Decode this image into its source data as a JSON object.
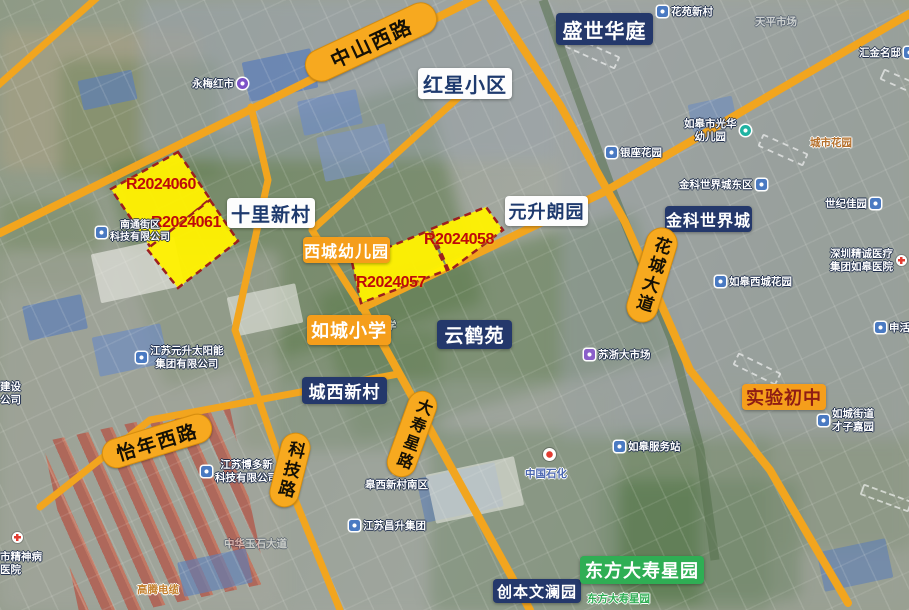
{
  "colors": {
    "road": "#F2A51E",
    "road_label_bg": "#F7A91F",
    "parcel_fill": "#FFF101",
    "parcel_border": "#9C1F1F",
    "parcel_text": "#BE0A0A",
    "navy_label_bg": "#24386B",
    "white_label_text": "#1E3A6E",
    "orange_label_bg": "#F59E1B",
    "green_label_bg": "#2FAE54",
    "experimental_school_text": "#8F1D14"
  },
  "road_labels": [
    {
      "text": "中山西路"
    },
    {
      "text": "怡年西路"
    },
    {
      "text": "科技路"
    },
    {
      "text": "大寿星路"
    },
    {
      "text": "花城大道"
    }
  ],
  "parcels": [
    {
      "label": "R2024060"
    },
    {
      "label": "R2024061"
    },
    {
      "label": "R2024057"
    },
    {
      "label": "R2024058"
    }
  ],
  "area_labels": [
    {
      "text": "盛世华庭",
      "style": "navy"
    },
    {
      "text": "红星小区",
      "style": "white"
    },
    {
      "text": "十里新村",
      "style": "white"
    },
    {
      "text": "元升朗园",
      "style": "white"
    },
    {
      "text": "西城幼儿园",
      "style": "orange"
    },
    {
      "text": "如城小学",
      "style": "orange"
    },
    {
      "text": "金科世界城",
      "style": "navy"
    },
    {
      "text": "云鹤苑",
      "style": "navy"
    },
    {
      "text": "城西新村",
      "style": "navy"
    },
    {
      "text": "实验初中",
      "style": "orange-red"
    },
    {
      "text": "创本文澜园",
      "style": "navy"
    },
    {
      "text": "东方大寿星园",
      "style": "green"
    }
  ],
  "poi_labels": [
    {
      "text": "永梅红市"
    },
    {
      "text": "花苑新村"
    },
    {
      "text": "天平市场"
    },
    {
      "text": "汇金名邸"
    },
    {
      "lines": [
        "如皋市光华",
        "幼儿园"
      ]
    },
    {
      "text": "银座花园"
    },
    {
      "text": "城市花园"
    },
    {
      "text": "金科世界城东区"
    },
    {
      "text": "世纪佳园"
    },
    {
      "lines": [
        "深圳精诚医疗",
        "集团如皋医院"
      ]
    },
    {
      "text": "如皋西城花园"
    },
    {
      "text": "申活"
    },
    {
      "text": "苏浙大市场"
    },
    {
      "text": "如皋服务站"
    },
    {
      "text": "中国石化"
    },
    {
      "lines": [
        "如城街道",
        "才子嘉园"
      ]
    },
    {
      "lines": [
        "江苏元升太阳能",
        "集团有限公司"
      ]
    },
    {
      "lines": [
        "南通街区",
        "科技有限公司"
      ]
    },
    {
      "lines": [
        "江苏博多新",
        "科技有限公司"
      ]
    },
    {
      "text": "皋西新村南区"
    },
    {
      "text": "江苏昌升集团"
    },
    {
      "text": "中华玉石大道"
    },
    {
      "text": "高腾电缆"
    },
    {
      "lines": [
        "建设",
        "公司"
      ]
    },
    {
      "lines": [
        "市精神病",
        "医院"
      ]
    },
    {
      "text": "学"
    },
    {
      "text": "东方大寿星园"
    }
  ]
}
